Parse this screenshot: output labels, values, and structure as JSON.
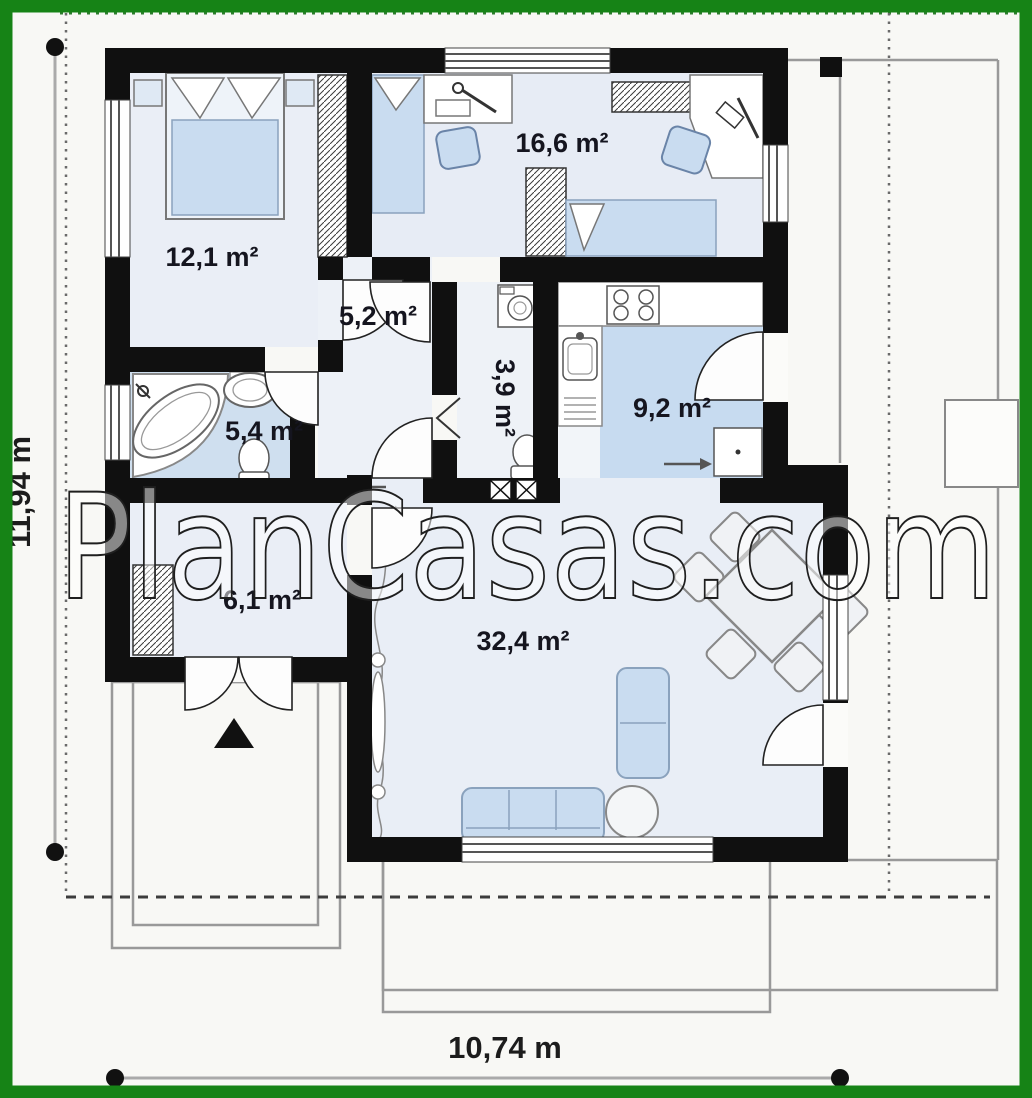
{
  "watermark": "PlanCasas.com",
  "dimensions": {
    "height_label": "11,94 m",
    "width_label": "10,74 m"
  },
  "rooms": {
    "bedroom1": {
      "area_label": "12,1 m²"
    },
    "bedroom2": {
      "area_label": "16,6 m²"
    },
    "hall": {
      "area_label": "5,2 m²"
    },
    "wc": {
      "area_label": "3,9 m²"
    },
    "kitchen": {
      "area_label": "9,2 m²"
    },
    "bathroom": {
      "area_label": "5,4 m²"
    },
    "vestibule": {
      "area_label": "6,1 m²"
    },
    "living": {
      "area_label": "32,4 m²"
    }
  },
  "colors": {
    "frame_green": "#168316",
    "wall_black": "#101010",
    "floor_pale_blue": "#e9eef6",
    "floor_blue": "#c7dbf0",
    "furniture_blue": "#c9dcf0",
    "outline_gray": "#999999"
  }
}
